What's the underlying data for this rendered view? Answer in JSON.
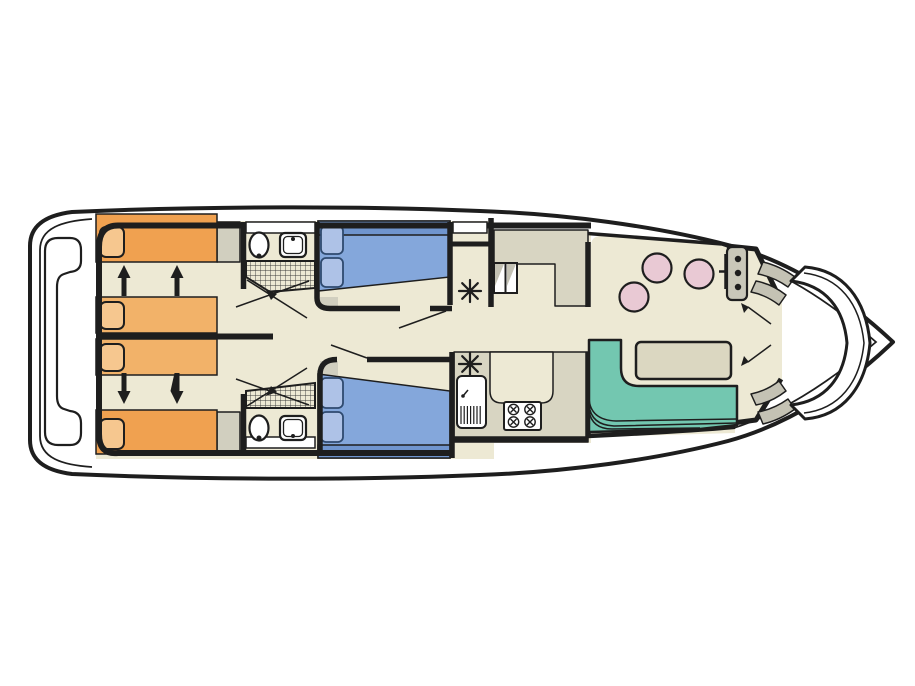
{
  "diagram": {
    "type": "boat-floor-plan",
    "orientation": "bow-right-stern-left",
    "rooms": [
      {
        "name": "stern-deck",
        "fixtures": [
          "stern-bench"
        ]
      },
      {
        "name": "aft-cabin-port",
        "fixtures": [
          "sliding-single-bed",
          "sliding-single-bed",
          "pillows",
          "slide-arrows-up"
        ]
      },
      {
        "name": "aft-cabin-starboard",
        "fixtures": [
          "sliding-single-bed",
          "sliding-single-bed",
          "pillows",
          "slide-arrows-down"
        ]
      },
      {
        "name": "bathroom-port",
        "fixtures": [
          "toilet",
          "washbasin",
          "shower",
          "door-swing-lines"
        ]
      },
      {
        "name": "bathroom-starboard",
        "fixtures": [
          "toilet",
          "washbasin",
          "shower",
          "door-swing-lines"
        ]
      },
      {
        "name": "mid-cabin-port",
        "fixtures": [
          "double-bed",
          "pillows",
          "bench",
          "wardrobe-with-vent"
        ]
      },
      {
        "name": "mid-cabin-starboard",
        "fixtures": [
          "double-bed",
          "pillows",
          "bench",
          "vent-locker"
        ]
      },
      {
        "name": "galley",
        "fixtures": [
          "companionway-steps",
          "counter",
          "sink-with-drainer",
          "stove-4-burner",
          "vent"
        ]
      },
      {
        "name": "saloon",
        "fixtures": [
          "l-shaped-bench",
          "dinette-table",
          "stool",
          "stool",
          "stool",
          "helm-console",
          "steering-wheel"
        ]
      },
      {
        "name": "bow-deck",
        "fixtures": [
          "boarding-steps",
          "boarding-steps",
          "curved-bow-bench",
          "double-doors"
        ]
      }
    ],
    "counts": {
      "stools": 3,
      "burners": 4,
      "cabins": 4,
      "bathrooms": 2,
      "vent_symbols": 3,
      "console_gauges": 3
    }
  },
  "colors": {
    "page": "#ffffff",
    "outline": "#1e1e1e",
    "white": "#ffffff",
    "floor": "#EDE9D4",
    "counter": "#D8D5C2",
    "cabinet_gray": "#D1CFBF",
    "bed_orange": "#F0A150",
    "bed_orange_light": "#F2B269",
    "pillow_orange": "#F6C78F",
    "bed_blue": "#84A7DB",
    "bed_blue_dark": "#7095CE",
    "pillow_blue": "#AEC2E7",
    "pillow_blue_border": "#2F4A6F",
    "bench_green": "#73C7B0",
    "stool_pink": "#E9C9D4",
    "table": "#DBD7C1",
    "console_gray": "#C9C7B9",
    "step_gray": "#C4C2B4",
    "hatch_line": "#3a3a3a"
  },
  "symbols": {
    "vent_star": "eight-spoked-asterisk",
    "slide_arrow": "bed-slide-direction-arrow"
  }
}
